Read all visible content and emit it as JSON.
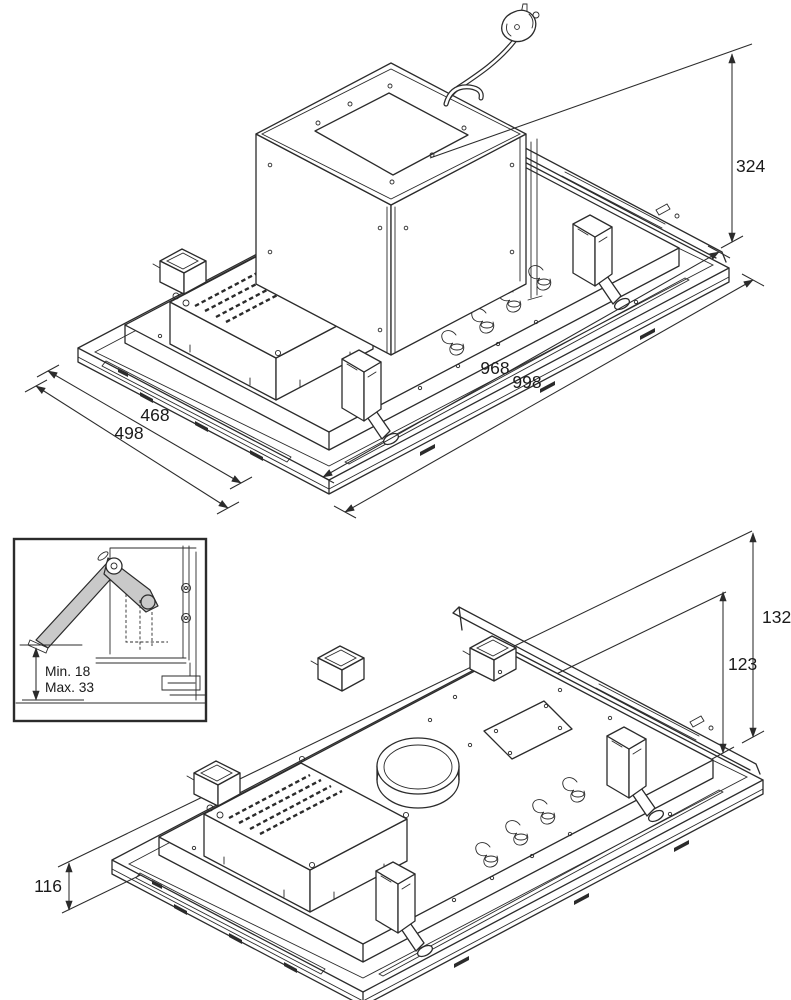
{
  "title": "Ceiling extractor hood installation dimensions drawing",
  "colors": {
    "line": "#2b2b2b",
    "background": "#ffffff",
    "gray_fill": "#c9c9c9",
    "text": "#1a1a1a"
  },
  "top_view": {
    "label": "isometric top view with motor housing and power plug",
    "dims": {
      "height_to_ceiling": "324",
      "cutout_length": "968",
      "panel_length": "998",
      "cutout_width": "468",
      "panel_width": "498"
    }
  },
  "bottom_view": {
    "label": "isometric bottom view with duct collar",
    "dims": {
      "height_total": "132",
      "height_recess": "123",
      "height_panel": "116"
    }
  },
  "inset": {
    "label": "spring clamp detail for ceiling thickness",
    "min_label": "Min. 18",
    "max_label": "Max. 33"
  }
}
